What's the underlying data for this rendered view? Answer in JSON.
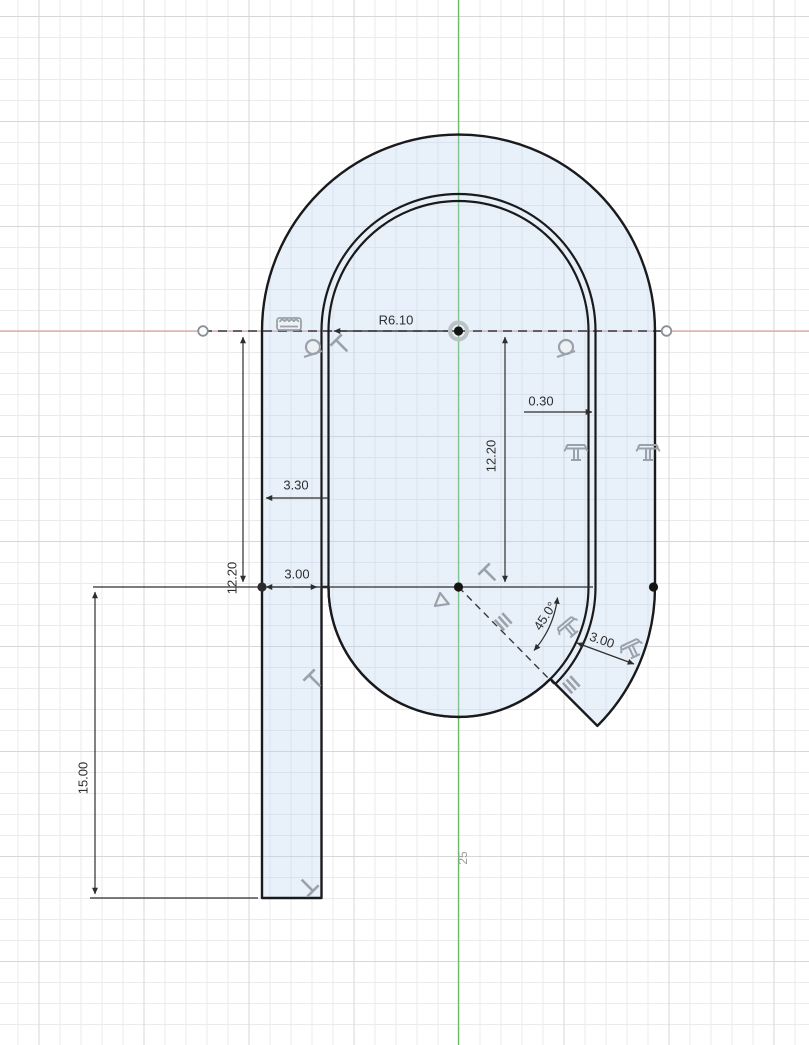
{
  "view": {
    "type": "cad-sketch-canvas",
    "grid_scale_label": "25",
    "axis_colors": {
      "horizontal_x_axis": "#d98c8c",
      "vertical_y_axis": "#58b558"
    },
    "profile_fill_color": "#e7f0f8",
    "sketch_line_color": "#1a1a1c",
    "dimension_color": "#2e2e2e",
    "constraint_icon_color": "#a7adb5"
  },
  "dimensions": {
    "inner_radius": "R6.10",
    "wall_offset": "0.30",
    "inner_height_right": "12.20",
    "outer_wall_left": "3.30",
    "leg_width": "3.00",
    "inner_height_left": "12.20",
    "leg_length": "15.00",
    "tail_angle": "45.0°",
    "tail_width": "3.00"
  },
  "icons": {
    "ruler-constraint-icon": "scalloped ruler glyph",
    "tangent-constraint-icon": "circle with tangent line (x2)",
    "perpendicular-constraint-icon": "tilted T glyph (x4)",
    "parallel-constraint-icon": "double slash glyph (x2)",
    "midpoint-constraint-icon": "triangle glyph",
    "offset-constraint-icon": "curled column glyph (x4)"
  },
  "points": {
    "origin_point": "sketch origin (center of top arcs)",
    "construction_endpoints": "open circles at ends of horizontal construction line",
    "sketch_points": "filled points on lower centerline"
  }
}
